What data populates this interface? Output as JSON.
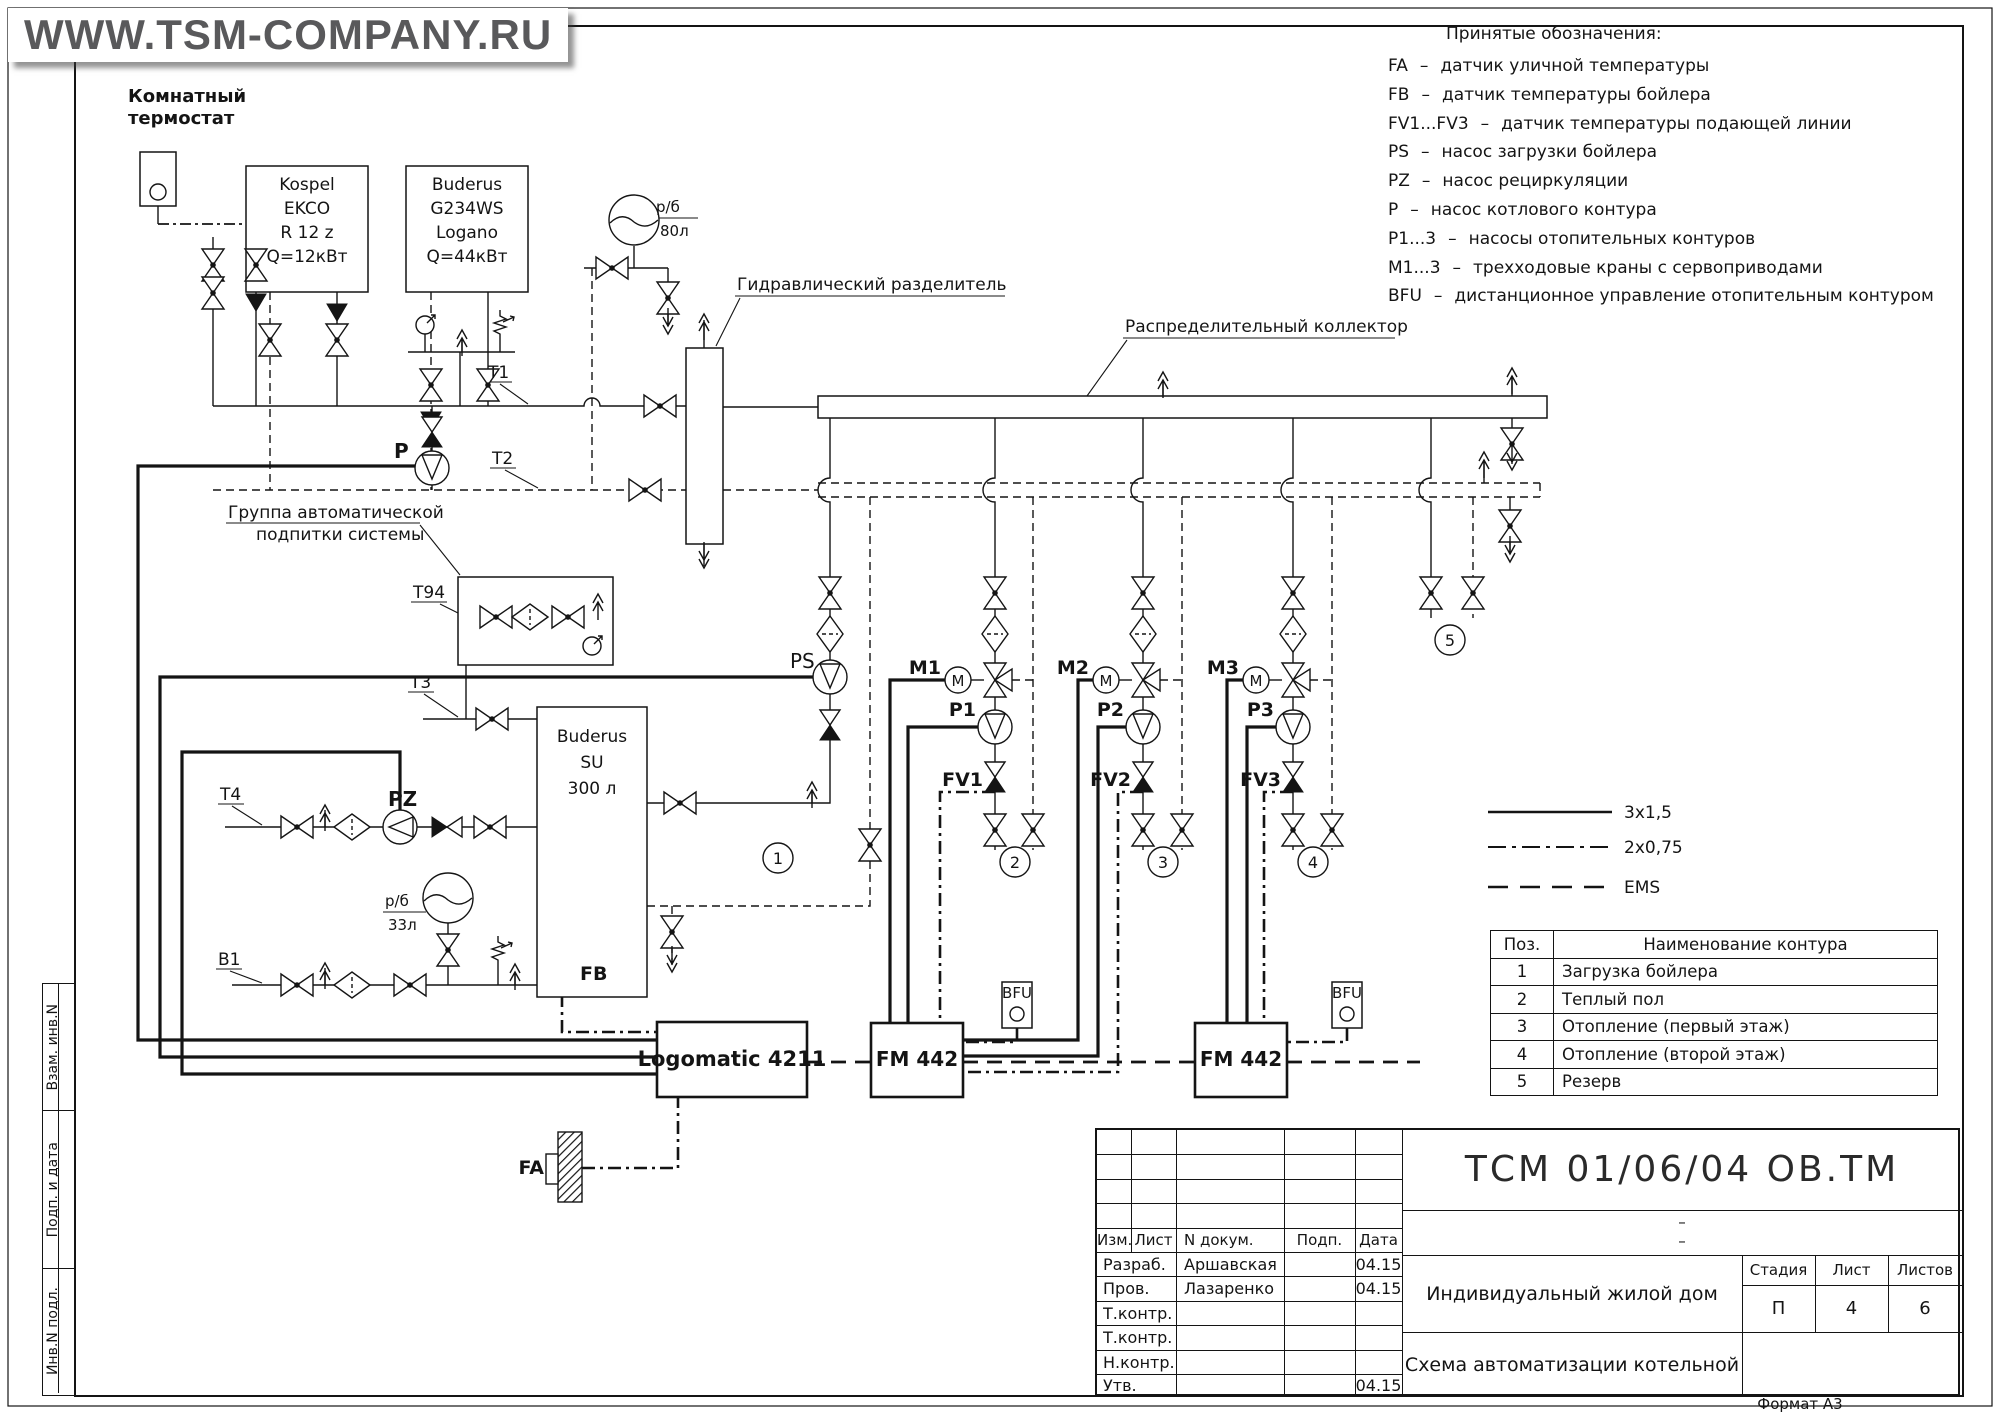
{
  "watermark": "WWW.TSM-COMPANY.RU",
  "legend": {
    "title": "Принятые обозначения:",
    "sep": "–",
    "items": [
      {
        "code": "FA",
        "desc": "датчик уличной температуры"
      },
      {
        "code": "FB",
        "desc": "датчик температуры бойлера"
      },
      {
        "code": "FV1...FV3",
        "desc": "датчик температуры подающей линии"
      },
      {
        "code": "PS",
        "desc": "насос загрузки бойлера"
      },
      {
        "code": "PZ",
        "desc": "насос рециркуляции"
      },
      {
        "code": "P",
        "desc": "насос котлового контура"
      },
      {
        "code": "P1...3",
        "desc": "насосы отопительных контуров"
      },
      {
        "code": "M1...3",
        "desc": "трехходовые краны с сервоприводами"
      },
      {
        "code": "BFU",
        "desc": "дистанционное управление отопительным контуром"
      }
    ]
  },
  "schematic": {
    "thermostat": [
      "Комнатный",
      "термостат"
    ],
    "kospel": [
      "Kospel",
      "EKCO",
      "R 12 z",
      "Q=12кВт"
    ],
    "buderus": [
      "Buderus",
      "G234WS",
      "Logano",
      "Q=44кВт"
    ],
    "tank": [
      "Buderus",
      "SU",
      "300 л"
    ],
    "separator_label": "Гидравлический разделитель",
    "collector_label": "Распределительный коллектор",
    "makeup_label": [
      "Группа автоматической",
      "подпитки системы"
    ],
    "controller": "Logomatic 4211",
    "fm_module": "FM 442",
    "bfu": "BFU",
    "exp80": {
      "num": "р/б",
      "den": "80л"
    },
    "exp33": {
      "num": "р/б",
      "den": "33л"
    },
    "m_letter": "M",
    "tags": {
      "t1": "T1",
      "t2": "T2",
      "t3": "T3",
      "t4": "T4",
      "t94": "T94",
      "b1": "B1",
      "p": "P",
      "ps": "PS",
      "pz": "PZ",
      "fb": "FB",
      "fa": "FA",
      "m1": "M1",
      "m2": "M2",
      "m3": "M3",
      "p1": "P1",
      "p2": "P2",
      "p3": "P3",
      "fv1": "FV1",
      "fv2": "FV2",
      "fv3": "FV3"
    },
    "circuit_badges": [
      "1",
      "2",
      "3",
      "4",
      "5"
    ]
  },
  "wire_legend": {
    "solid": "3x1,5",
    "dashdot": "2x0,75",
    "dashed": "EMS"
  },
  "contour_table": {
    "col_pos": "Поз.",
    "col_name": "Наименование контура",
    "rows": [
      {
        "pos": "1",
        "name": "Загрузка бойлера"
      },
      {
        "pos": "2",
        "name": "Теплый пол"
      },
      {
        "pos": "3",
        "name": "Отопление (первый этаж)"
      },
      {
        "pos": "4",
        "name": "Отопление (второй этаж)"
      },
      {
        "pos": "5",
        "name": "Резерв"
      }
    ]
  },
  "title_block": {
    "doc_number": "ТСМ 01/06/04 ОВ.ТМ",
    "dash_top": "–",
    "dash_bottom": "–",
    "col_izm": "Изм.",
    "col_list": "Лист",
    "col_doc": "N докум.",
    "col_sign": "Подп.",
    "col_date": "Дата",
    "row_dev_role": "Разраб.",
    "row_dev_name": "Аршавская",
    "row_dev_date": "04.15",
    "row_chk_role": "Пров.",
    "row_chk_name": "Лазаренко",
    "row_chk_date": "04.15",
    "row_t1_role": "Т.контр.",
    "row_t2_role": "Т.контр.",
    "row_n_role": "Н.контр.",
    "row_app_role": "Утв.",
    "row_app_date": "04.15",
    "object_name": "Индивидуальный жилой дом",
    "stage_label": "Стадия",
    "sheet_label": "Лист",
    "sheets_label": "Листов",
    "stage_value": "П",
    "sheet_value": "4",
    "sheets_value": "6",
    "sheet_name": "Схема автоматизации котельной"
  },
  "side_strip": {
    "top": "Взам. инв.N",
    "middle": "Подп. и дата",
    "bottom": "Инв.N подл."
  },
  "format_label": "Формат А3"
}
